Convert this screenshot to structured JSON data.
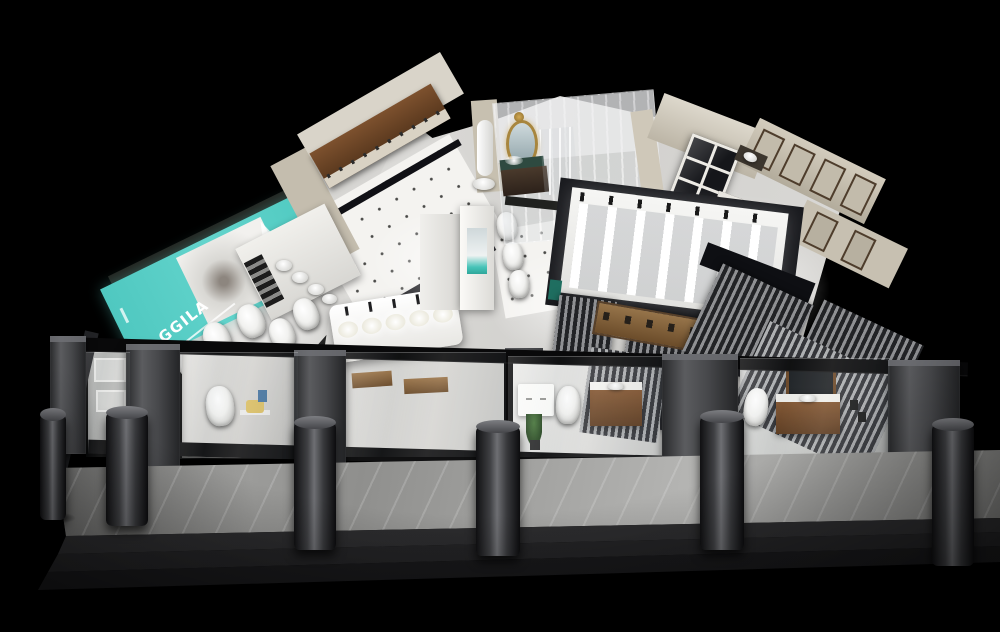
{
  "canvas": {
    "width": 1000,
    "height": 632,
    "background_color": "#000000"
  },
  "subject": "3D isometric night render of a bathroom and sanitary-ware showroom",
  "brand_sign": {
    "text": "AGGILA",
    "stylized_initial": "A",
    "text_rest": "GGILA",
    "panel_color": "#58cfc6",
    "text_color": "#ffffff"
  },
  "palette": {
    "background": "#000000",
    "marble_floor": "#d9d8d5",
    "dotted_tile_floor": "#f3f2ef",
    "beige_wall": "#cdc6b7",
    "dark_wood": "#6b4527",
    "storefront_frame": "#0a0a0b",
    "pillar_gray": "#48494c",
    "accent_teal": "#58cfc6",
    "gold_mirror": "#a8863e",
    "plant_green": "#3f6b35"
  },
  "visible_fixtures": [
    "toilets",
    "wash-basins",
    "faucet-display-table",
    "shower-columns",
    "vanity-cabinets",
    "ornate-gold-mirror",
    "paned-window",
    "slatted-partitions",
    "glass-display-windows",
    "cylindrical-columns",
    "entry-steps",
    "billboard-sign"
  ]
}
